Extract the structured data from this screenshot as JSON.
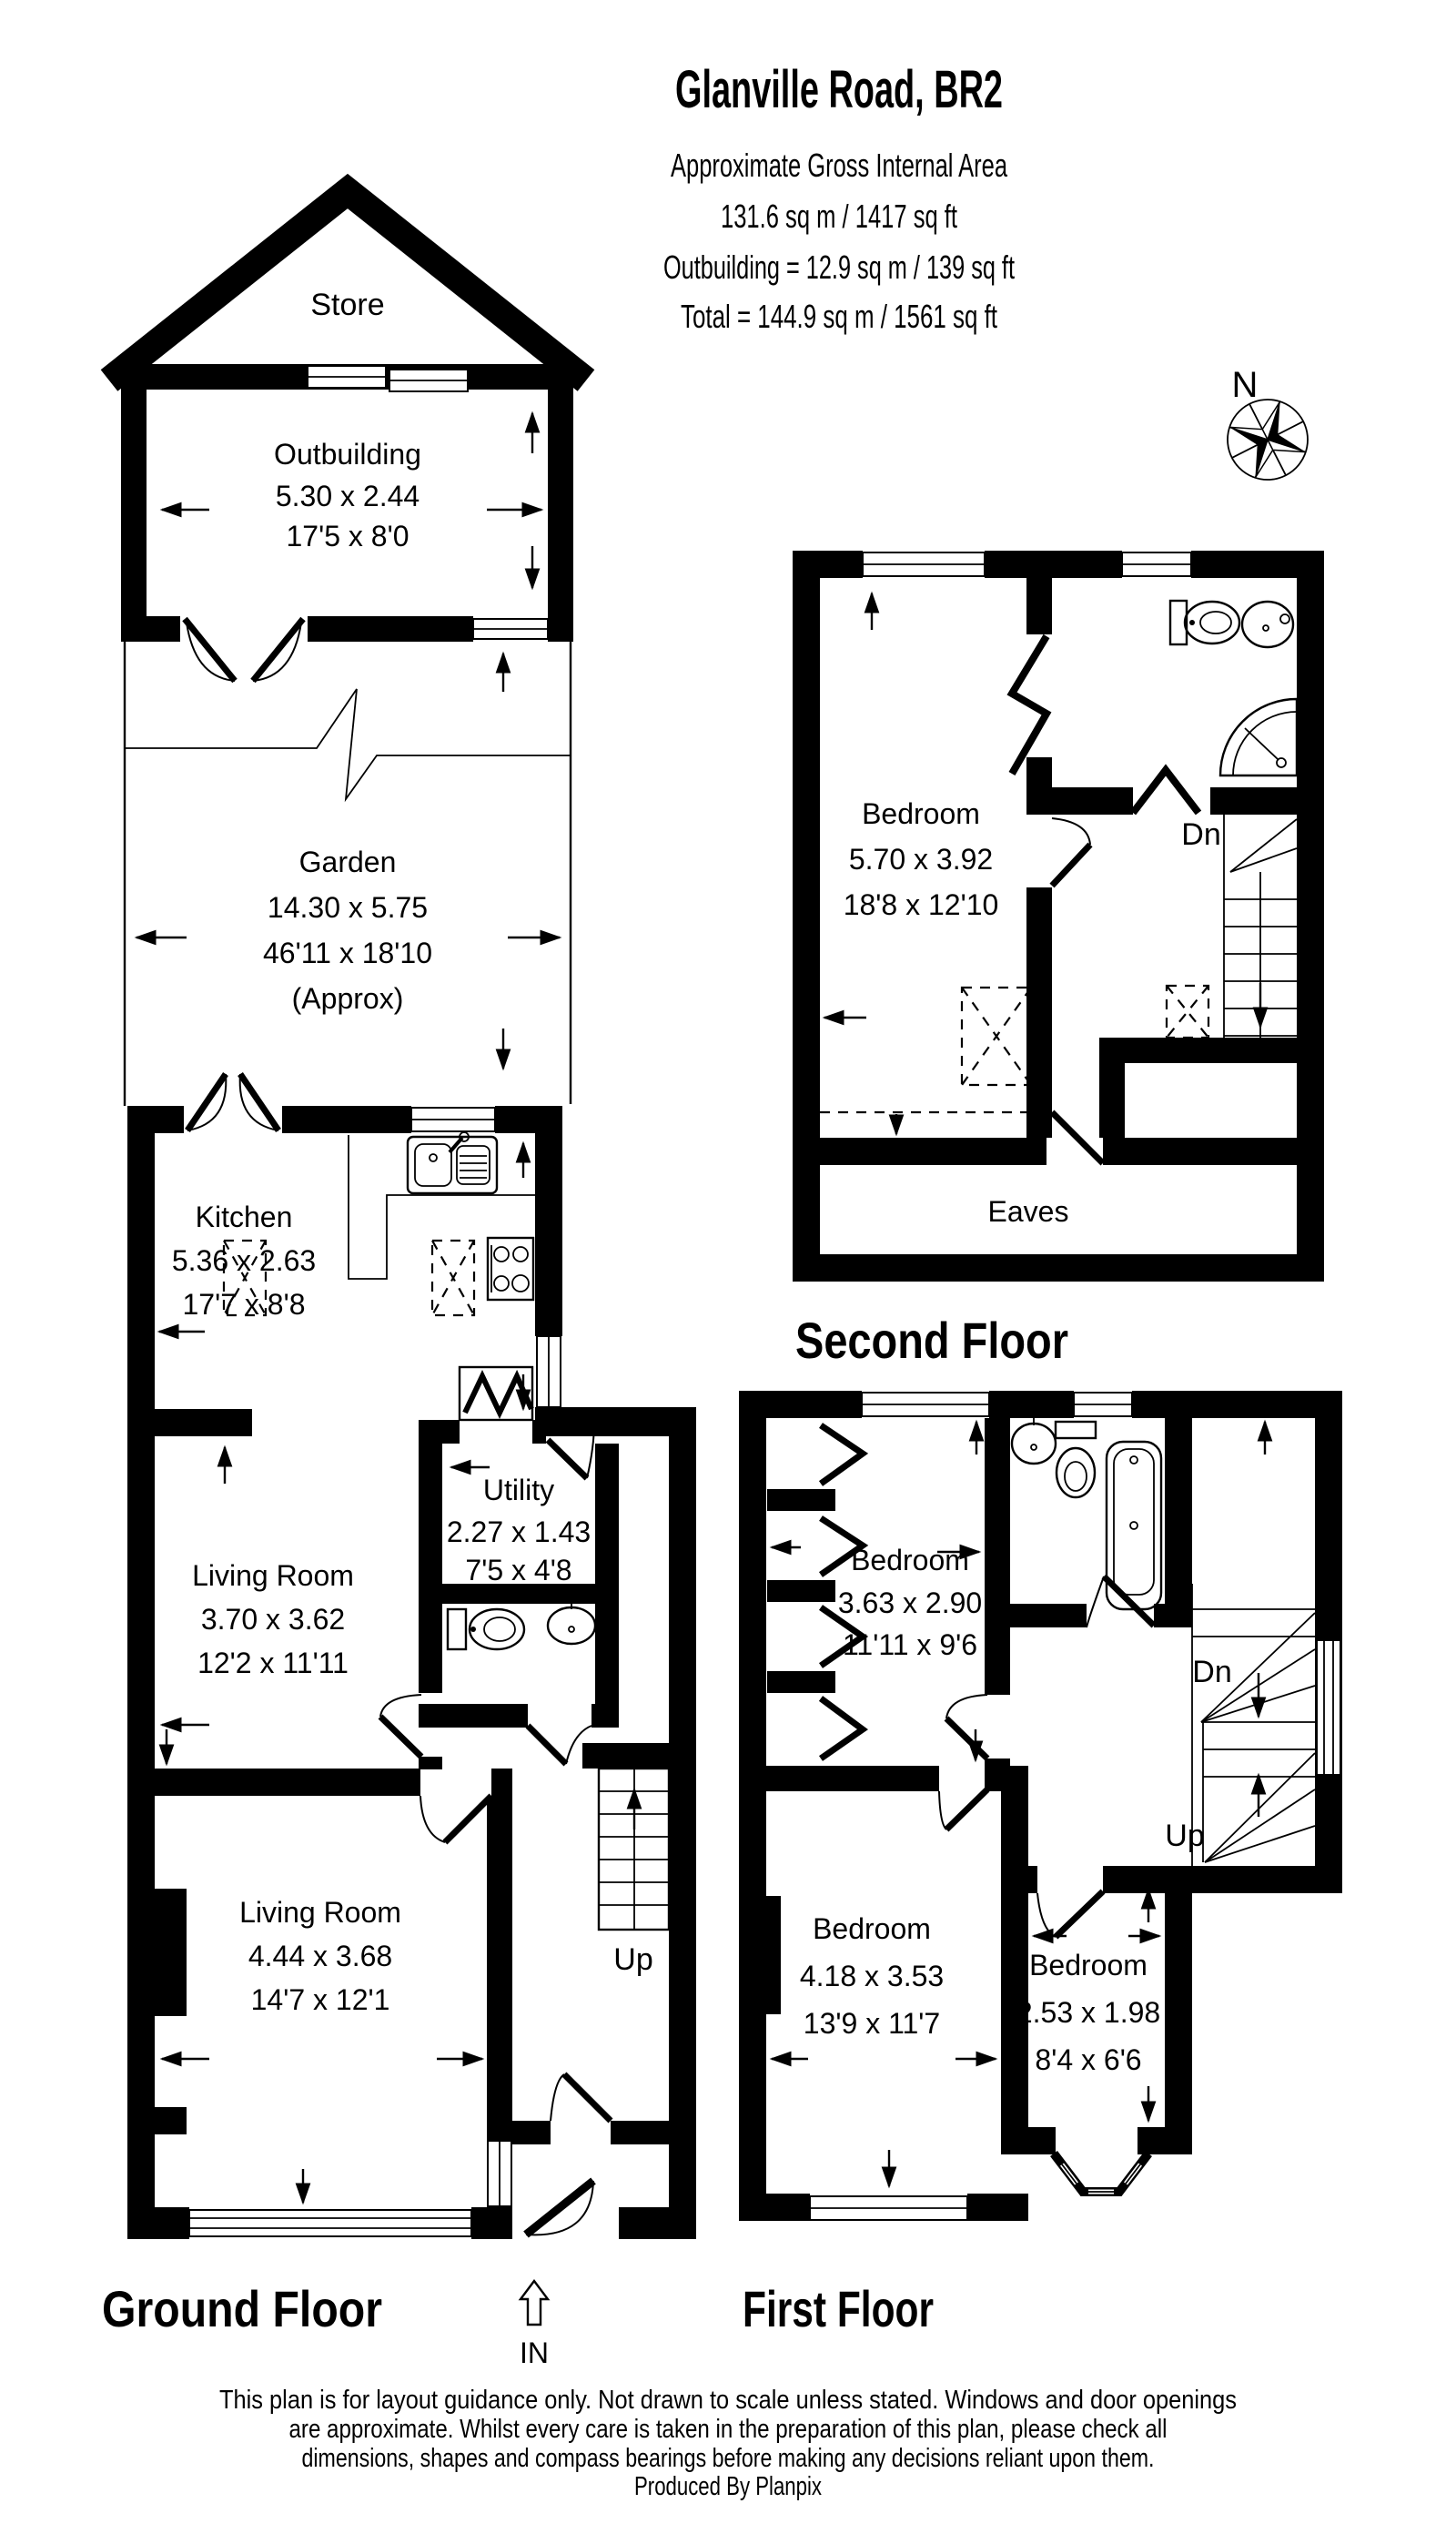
{
  "header": {
    "title": "Glanville Road, BR2",
    "subtitle1": "Approximate Gross Internal Area",
    "subtitle2": "131.6 sq m / 1417 sq ft",
    "subtitle3": "Outbuilding = 12.9 sq m / 139 sq ft",
    "subtitle4": "Total = 144.9 sq m / 1561 sq ft"
  },
  "compass": {
    "north_label": "N"
  },
  "ground_floor": {
    "heading": "Ground Floor",
    "store": {
      "name": "Store"
    },
    "outbuilding": {
      "name": "Outbuilding",
      "metric": "5.30 x 2.44",
      "imperial": "17'5 x 8'0"
    },
    "garden": {
      "name": "Garden",
      "metric": "14.30 x 5.75",
      "imperial": "46'11 x 18'10",
      "approx": "(Approx)"
    },
    "kitchen": {
      "name": "Kitchen",
      "metric": "5.36 x 2.63",
      "imperial": "17'7 x 8'8"
    },
    "utility": {
      "name": "Utility",
      "metric": "2.27 x 1.43",
      "imperial": "7'5 x 4'8"
    },
    "living_room_rear": {
      "name": "Living Room",
      "metric": "3.70 x 3.62",
      "imperial": "12'2 x 11'11"
    },
    "living_room_front": {
      "name": "Living Room",
      "metric": "4.44 x 3.68",
      "imperial": "14'7 x 12'1"
    },
    "stairs_label": "Up",
    "entrance_label": "IN"
  },
  "second_floor": {
    "heading": "Second Floor",
    "bedroom": {
      "name": "Bedroom",
      "metric": "5.70 x 3.92",
      "imperial": "18'8 x 12'10"
    },
    "eaves_label": "Eaves",
    "stairs_label": "Dn"
  },
  "first_floor": {
    "heading": "First Floor",
    "bedroom_rear": {
      "name": "Bedroom",
      "metric": "3.63 x 2.90",
      "imperial": "11'11 x 9'6"
    },
    "bedroom_front": {
      "name": "Bedroom",
      "metric": "4.18 x 3.53",
      "imperial": "13'9 x 11'7"
    },
    "bedroom_small": {
      "name": "Bedroom",
      "metric": "2.53 x 1.98",
      "imperial": "8'4 x 6'6"
    },
    "stairs_down_label": "Dn",
    "stairs_up_label": "Up"
  },
  "footer": {
    "line1": "This plan is for layout guidance only. Not drawn to scale unless stated. Windows and door openings",
    "line2": "are approximate. Whilst every care is taken in the preparation of this plan, please check all",
    "line3": "dimensions, shapes and compass bearings before making any decisions reliant upon them.",
    "line4": "Produced By Planpix"
  }
}
